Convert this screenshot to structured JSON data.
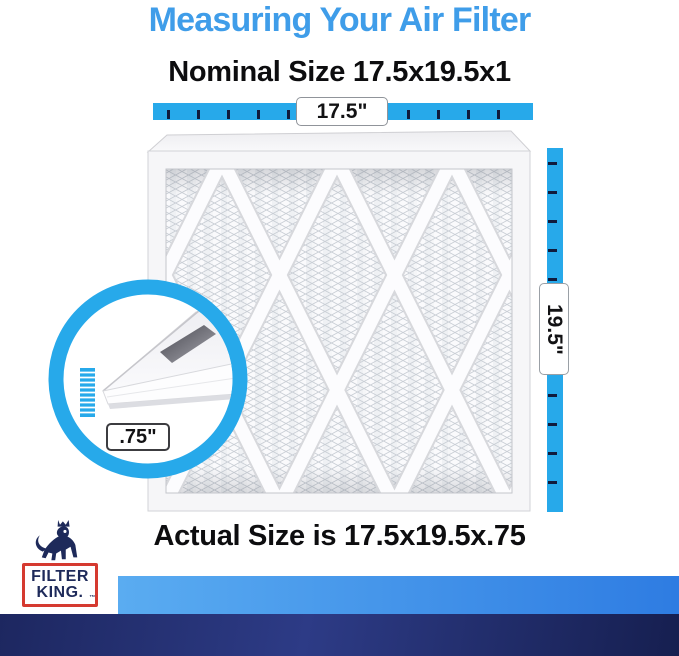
{
  "header": {
    "title": "Measuring Your Air Filter",
    "nominal_size_label": "Nominal Size 17.5x19.5x1"
  },
  "footer": {
    "actual_size_label": "Actual Size is 17.5x19.5x.75"
  },
  "measurements": {
    "width": "17.5\"",
    "height": "19.5\"",
    "depth": ".75\""
  },
  "logo": {
    "line1": "FILTER",
    "line2": "KING.",
    "trademark": "™"
  },
  "colors": {
    "accent_blue": "#27a9ea",
    "title_blue": "#3f9de9",
    "text_black": "#0d0d0f",
    "tick_navy": "#101b3c",
    "logo_navy": "#1e2a5a",
    "logo_red": "#d53a30",
    "band_blue_left": "#5aacf1",
    "band_blue_right": "#2e7ce2",
    "footer_navy_dark": "#161f50",
    "footer_navy_mid": "#2d3b86"
  }
}
